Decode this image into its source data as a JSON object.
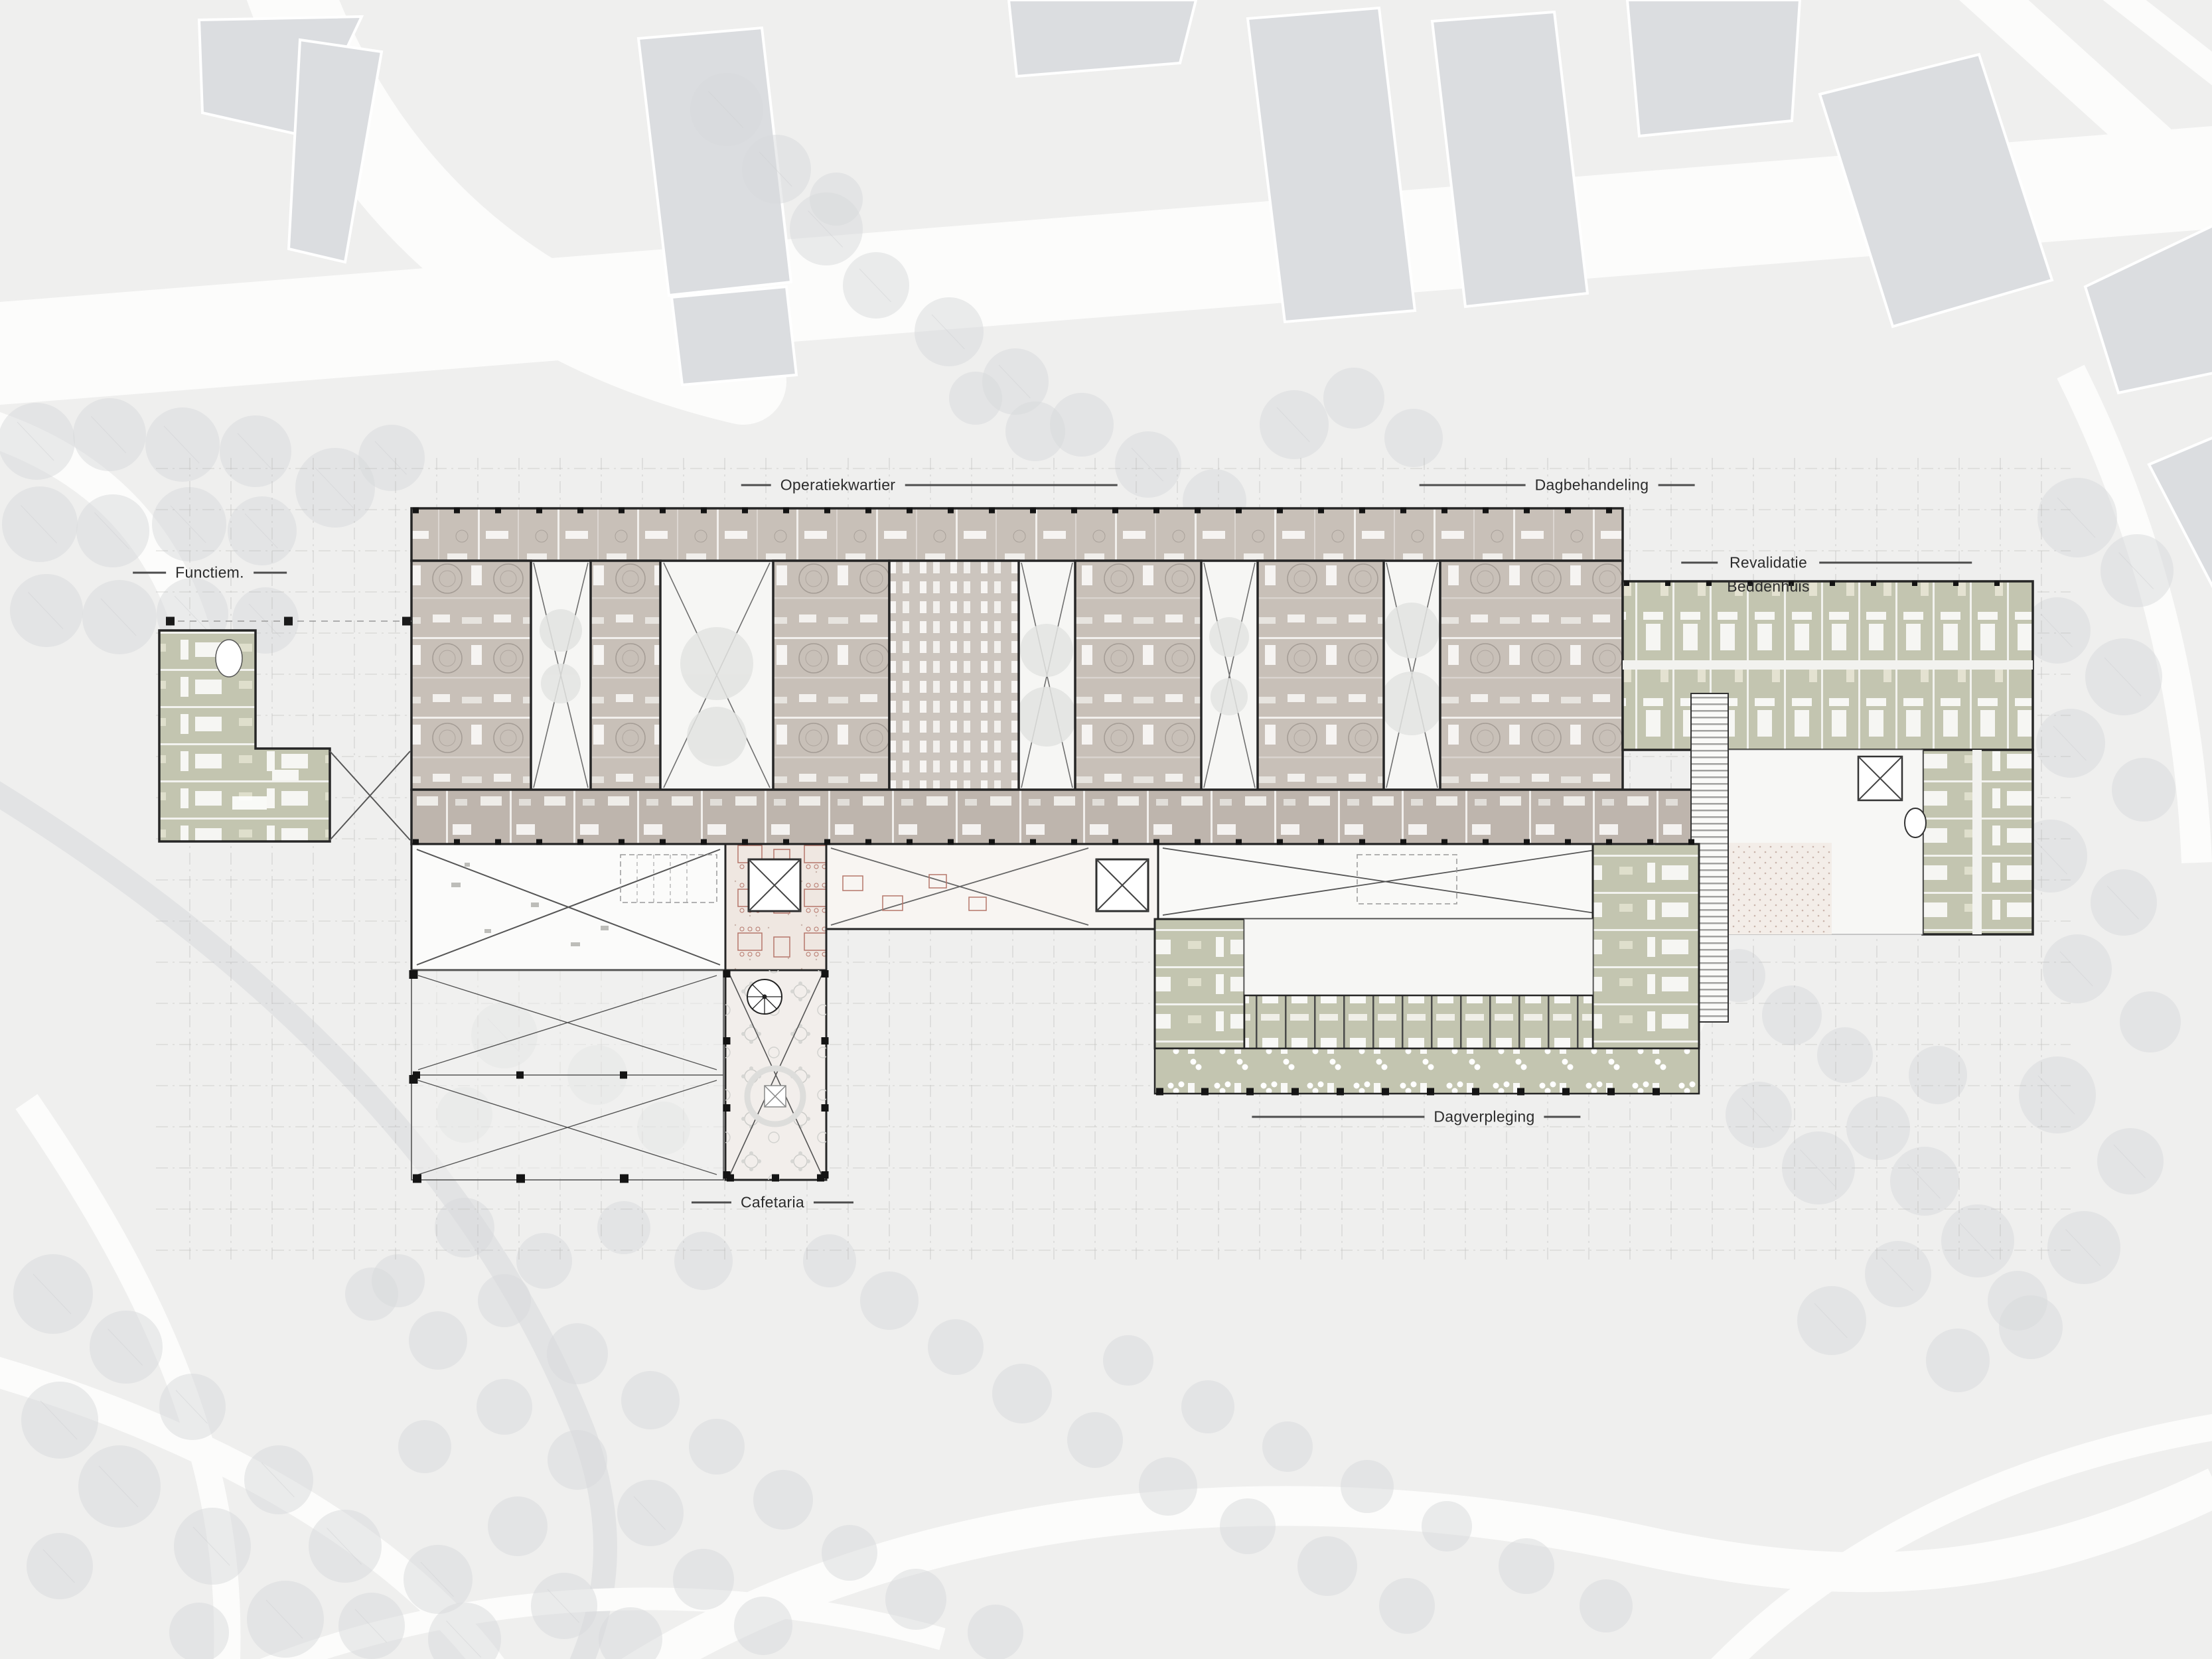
{
  "labels": {
    "operatiekwartier": "Operatiekwartier",
    "dagbehandeling": "Dagbehandeling",
    "revalidatie": "Revalidatie",
    "beddenhuis": "Beddenhuis",
    "functiemetingen": "Functiem.",
    "cafetaria": "Cafetaria",
    "dagverpleging": "Dagverpleging"
  },
  "colors": {
    "background": "#efefee",
    "context_building": "#dbdde0",
    "tree": "#d8dadc",
    "room_taupe": "#c8c0b8",
    "room_taupe_deep": "#beb5ad",
    "room_sage": "#c3c5b0",
    "floor_pink": "#efe7e1",
    "floor_white": "#fbfbfa",
    "wall": "#262626",
    "road": "#fcfcfb",
    "grid_line": "#b9b9b7",
    "furniture_red": "#b5766a",
    "label_text": "#2b2b2b"
  }
}
